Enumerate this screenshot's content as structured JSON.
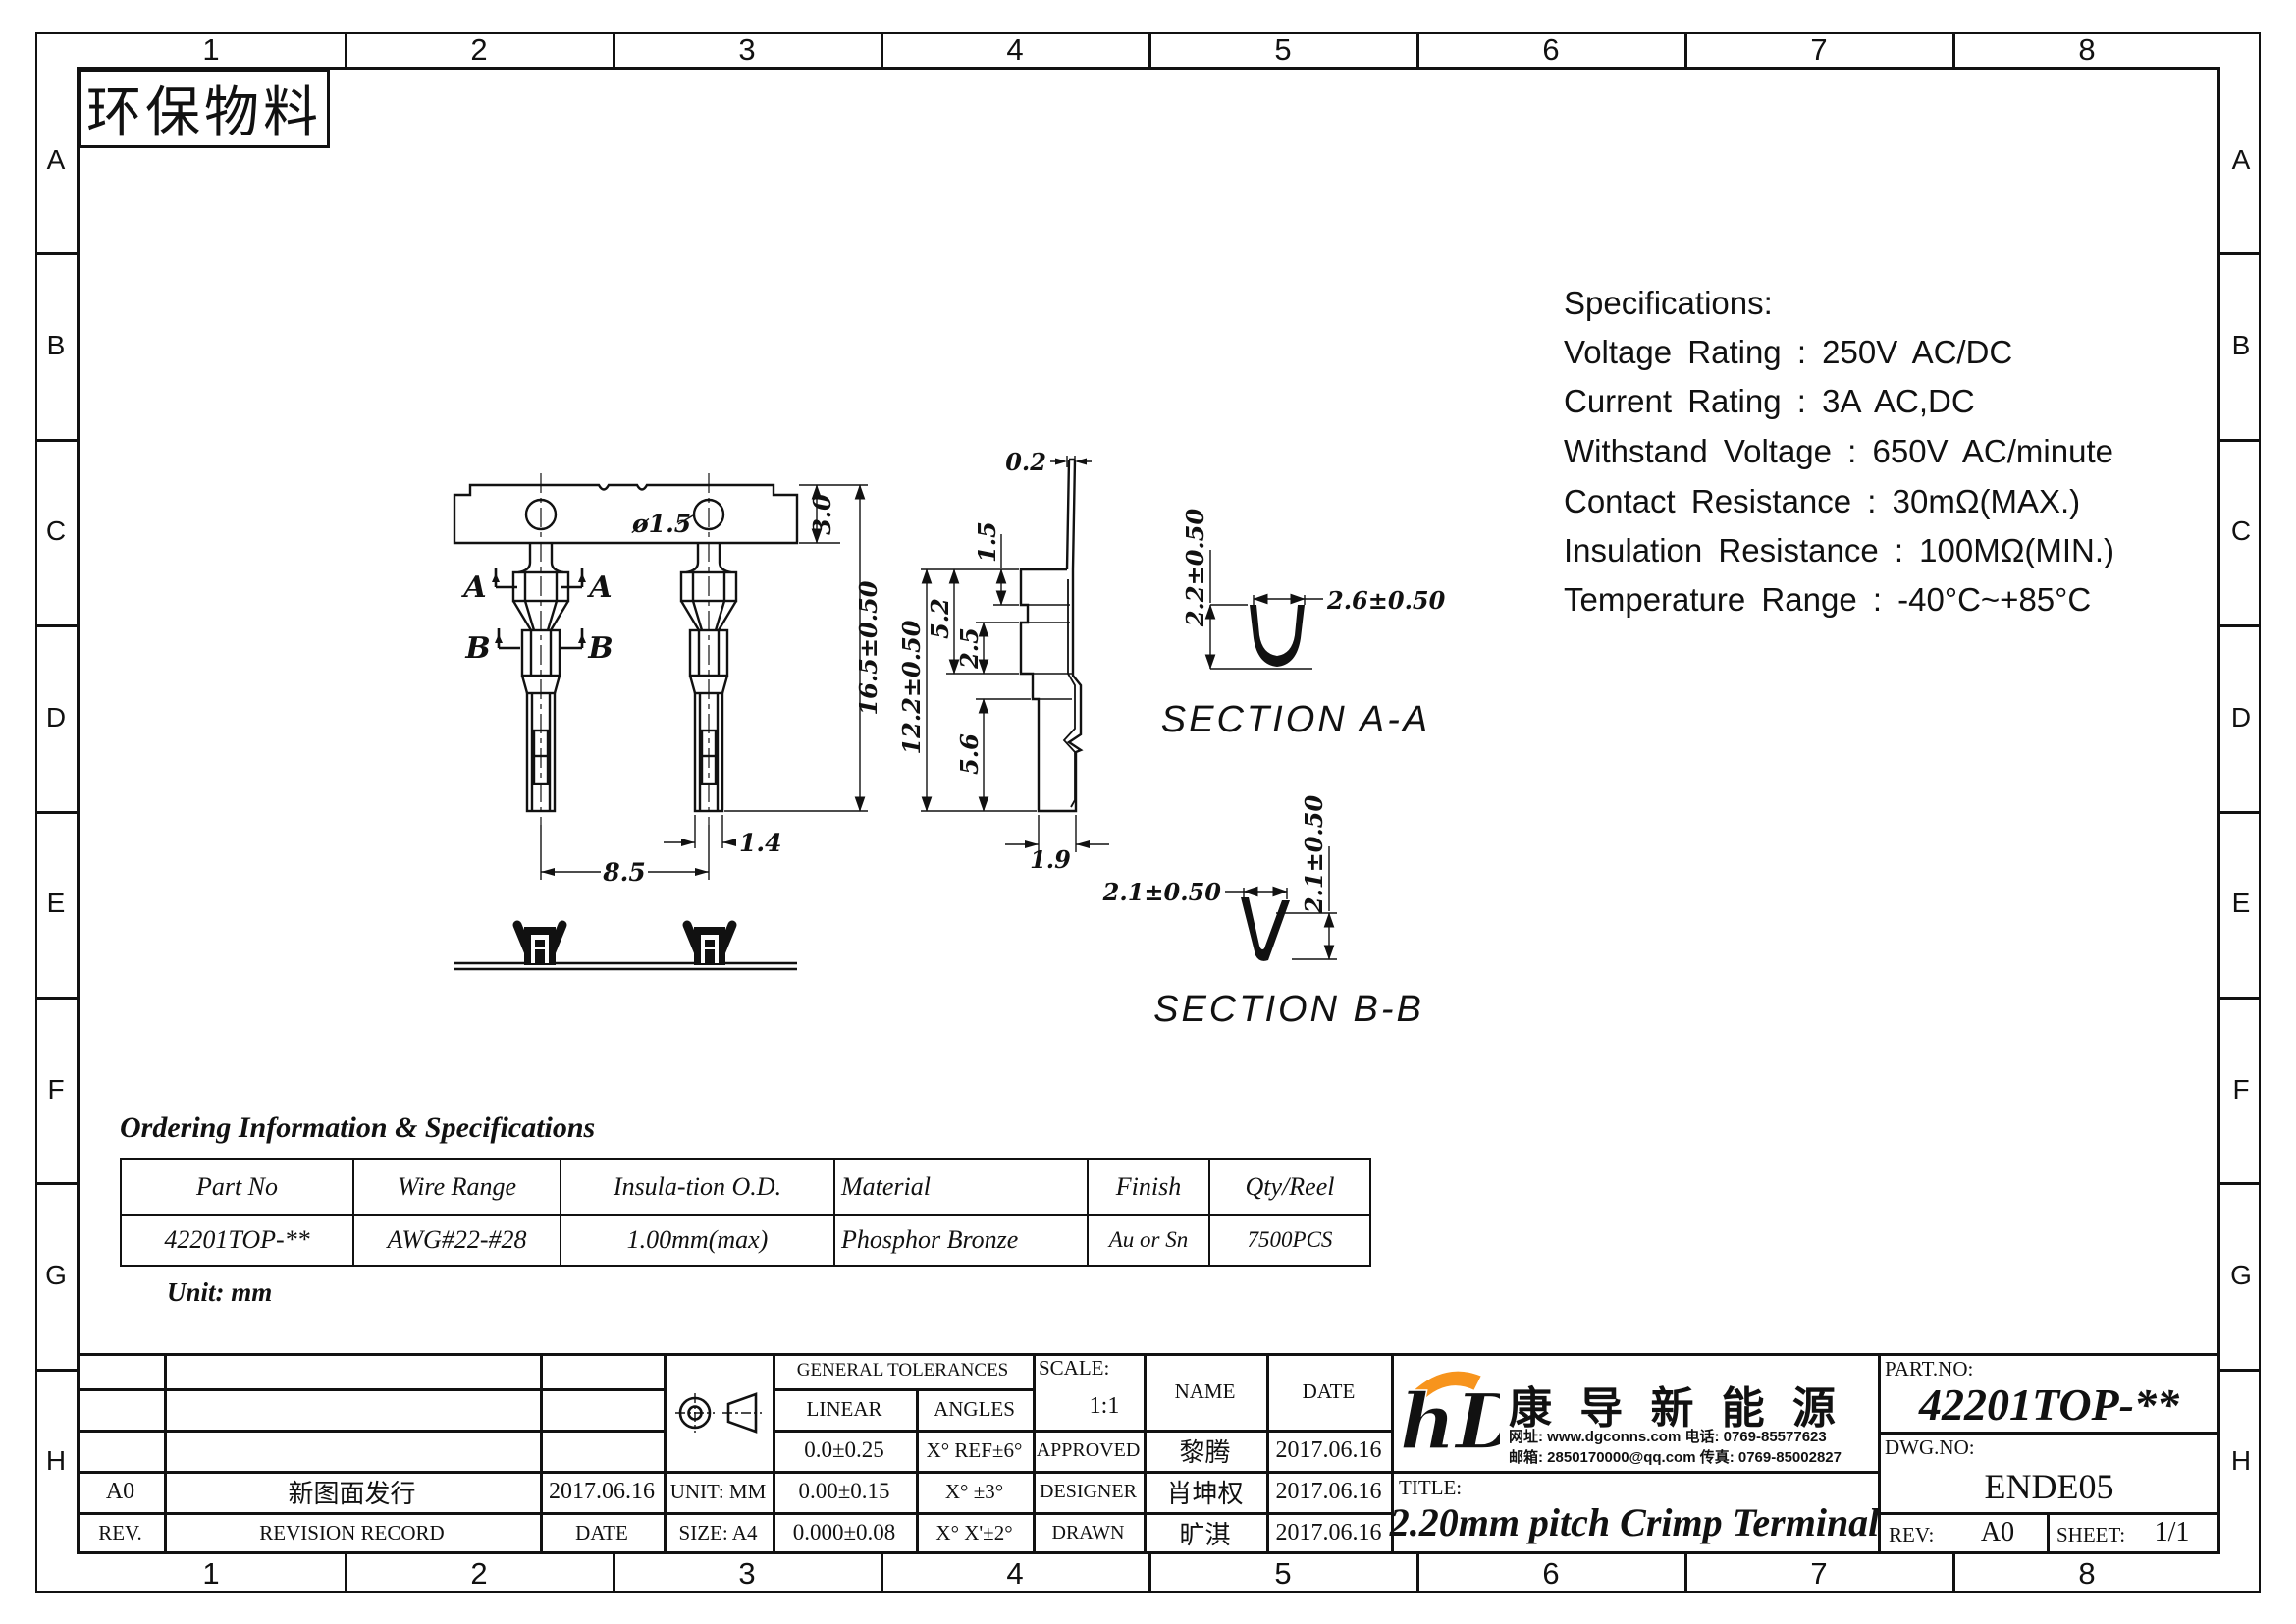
{
  "sheet": {
    "eco_label": "环保物料",
    "column_labels": [
      "1",
      "2",
      "3",
      "4",
      "5",
      "6",
      "7",
      "8"
    ],
    "row_labels": [
      "A",
      "B",
      "C",
      "D",
      "E",
      "F",
      "G",
      "H"
    ]
  },
  "specs": {
    "title": "Specifications:",
    "line1": "Voltage Rating : 250V AC/DC",
    "line2": "Current Rating : 3A AC,DC",
    "line3": "Withstand Voltage : 650V AC/minute",
    "line4": "Contact Resistance : 30mΩ(MAX.)",
    "line5": "Insulation Resistance : 100MΩ(MIN.)",
    "line6": "Temperature Range : -40°C~+85°C"
  },
  "drawing": {
    "front": {
      "hole_dia": "ø1.5",
      "strip_h": "3.0",
      "overall_h": "16.5±0.50",
      "pitch": "8.5",
      "tip_w": "1.4",
      "sec_a": "A",
      "sec_b": "B"
    },
    "side": {
      "t": "0.2",
      "d1": "1.5",
      "d2": "5.2",
      "d3": "2.5",
      "overall": "12.2±0.50",
      "d4": "5.6",
      "w": "1.9"
    },
    "aa": {
      "label": "SECTION A-A",
      "height": "2.2±0.50",
      "width": "2.6±0.50"
    },
    "bb": {
      "label": "SECTION B-B",
      "width": "2.1±0.50",
      "depth": "2.1±0.50"
    }
  },
  "ordering": {
    "title": "Ordering Information & Specifications",
    "col1": "Part No",
    "col2": "Wire Range",
    "col3": "Insula-tion O.D.",
    "col4": "Material",
    "col5": "Finish",
    "col6": "Qty/Reel",
    "v1": "42201TOP-**",
    "v2": "AWG#22-#28",
    "v3": "1.00mm(max)",
    "v4": "Phosphor Bronze",
    "v5": "Au or Sn",
    "v6": "7500PCS",
    "unit": "Unit: mm"
  },
  "titleblock": {
    "rev_entry": {
      "rev": "A0",
      "record": "新图面发行",
      "date": "2017.06.16"
    },
    "rev_header": {
      "rev": "REV.",
      "record": "REVISION RECORD",
      "date": "DATE"
    },
    "tol": {
      "title": "GENERAL TOLERANCES",
      "linear": "LINEAR",
      "angles": "ANGLES",
      "l1": "0.0±0.25",
      "a1": "X° REF±6°",
      "l2": "0.00±0.15",
      "a2": "X° ±3°",
      "l3": "0.000±0.08",
      "a3": "X° X'±2°"
    },
    "unit": "UNIT: MM",
    "size": "SIZE: A4",
    "scale_label": "SCALE:",
    "scale": "1:1",
    "name_h": "NAME",
    "date_h": "DATE",
    "approved_label": "APPROVED",
    "approved_name": "黎腾",
    "approved_date": "2017.06.16",
    "designer_label": "DESIGNER",
    "designer_name": "肖坤权",
    "designer_date": "2017.06.16",
    "drawn_label": "DRAWN",
    "drawn_name": "旷淇",
    "drawn_date": "2017.06.16",
    "company": {
      "name": "康 导 新 能 源",
      "contact1": "网址: www.dgconns.com   电话: 0769-85577623",
      "contact2": "邮箱: 2850170000@qq.com 传真: 0769-85002827"
    },
    "title_label": "TITLE:",
    "title": "2.20mm pitch Crimp Terminal",
    "partno_label": "PART.NO:",
    "partno": "42201TOP-**",
    "dwgno_label": "DWG.NO:",
    "dwgno": "ENDE05",
    "rev_label": "REV:",
    "rev": "A0",
    "sheet_label": "SHEET:",
    "sheet": "1/1"
  },
  "colors": {
    "logo_blue": "#29abe2",
    "logo_orange": "#f7941d"
  }
}
